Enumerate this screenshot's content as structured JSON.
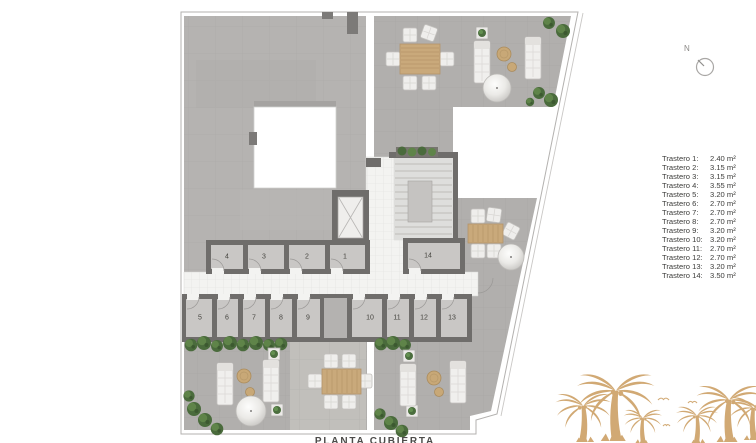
{
  "meta": {
    "title_label": "PLANTA CUBIERTA"
  },
  "compass": {
    "label": "N"
  },
  "legend": {
    "items": [
      {
        "label": "Trastero 1:",
        "value": "2.40 m²"
      },
      {
        "label": "Trastero 2:",
        "value": "3.15 m²"
      },
      {
        "label": "Trastero 3:",
        "value": "3.15 m²"
      },
      {
        "label": "Trastero 4:",
        "value": "3.55 m²"
      },
      {
        "label": "Trastero 5:",
        "value": "3.20 m²"
      },
      {
        "label": "Trastero 6:",
        "value": "2.70 m²"
      },
      {
        "label": "Trastero 7:",
        "value": "2.70 m²"
      },
      {
        "label": "Trastero 8:",
        "value": "2.70 m²"
      },
      {
        "label": "Trastero 9:",
        "value": "3.20 m²"
      },
      {
        "label": "Trastero 10:",
        "value": "3.20 m²"
      },
      {
        "label": "Trastero 11:",
        "value": "2.70 m²"
      },
      {
        "label": "Trastero 12:",
        "value": "2.70 m²"
      },
      {
        "label": "Trastero 13:",
        "value": "3.20 m²"
      },
      {
        "label": "Trastero 14:",
        "value": "3.50 m²"
      }
    ]
  },
  "plan": {
    "rooms": [
      {
        "id": "1",
        "label": "1"
      },
      {
        "id": "2",
        "label": "2"
      },
      {
        "id": "3",
        "label": "3"
      },
      {
        "id": "4",
        "label": "4"
      },
      {
        "id": "5",
        "label": "5"
      },
      {
        "id": "6",
        "label": "6"
      },
      {
        "id": "7",
        "label": "7"
      },
      {
        "id": "8",
        "label": "8"
      },
      {
        "id": "9",
        "label": "9"
      },
      {
        "id": "10",
        "label": "10"
      },
      {
        "id": "11",
        "label": "11"
      },
      {
        "id": "12",
        "label": "12"
      },
      {
        "id": "13",
        "label": "13"
      },
      {
        "id": "14",
        "label": "14"
      }
    ]
  },
  "colors": {
    "roof_gray": "#b5b3b1",
    "wall_dark": "#6f6d6b",
    "corridor_tile": "#f3f3f1",
    "wood": "#c9a97b",
    "plant_green": "#4a6b3c",
    "watermark_tan": "#cfa56d"
  }
}
